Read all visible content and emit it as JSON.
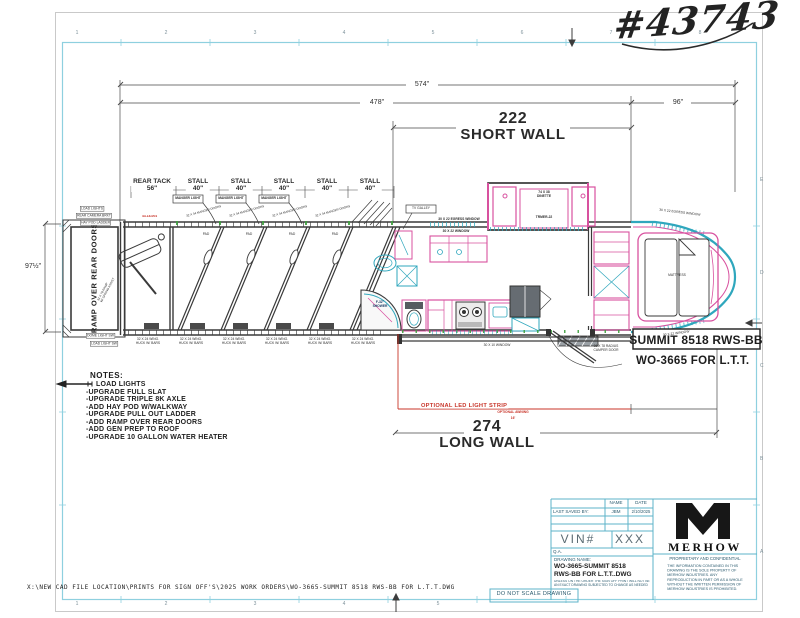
{
  "sheet": {
    "handwritten_number": "#43743",
    "footer_path": "X:\\NEW CAD FILE LOCATION\\PRINTS FOR SIGN OFF'S\\2025 WORK ORDERS\\WO-3665-SUMMIT 8518 RWS-BB FOR L.T.T.DWG",
    "do_not_scale": "DO NOT SCALE DRAWING",
    "ruler_cols": [
      "1",
      "2",
      "3",
      "4",
      "5",
      "6",
      "7",
      "8"
    ],
    "ruler_rows": [
      "E",
      "D",
      "C",
      "B",
      "A"
    ]
  },
  "dims": {
    "total": "574\"",
    "body": "478\"",
    "nose": "96\"",
    "height": "97½\"",
    "short_wall_value": "222",
    "short_wall_label": "SHORT WALL",
    "long_wall_value": "274",
    "long_wall_label": "LONG WALL"
  },
  "horse_area": {
    "rear_tack_label": "REAR TACK",
    "rear_tack_size": "56\"",
    "stall_label": "STALL",
    "stall_size": "40\"",
    "manger_light": "MANGER LIGHT",
    "manger_door": "32 X 34 MANGER DOORS",
    "pad": "PAD",
    "wing_line1": "32 X 24 WING.",
    "wing_line2": "HUCK W/ BARS",
    "ramp_label": "RAMP OVER REAR DOORS",
    "ramp_note_1": "32 X 78 RAMP",
    "ramp_note_2": "W/ SPRING ASSIST",
    "code_red": "43-18-004",
    "callouts": [
      "LOAD LIGHTS",
      "REAR CAMERA BRKT",
      "HAY POD LADDER",
      "DOME LIGHT SW",
      "LOAD LIGHT SW"
    ]
  },
  "lq": {
    "tv_galley": "TV GALLEY",
    "egress_window": "30 X 22 EGRESS WINDOW",
    "window": "30 X 22 WINDOW",
    "dinette_line1": "74 X 38",
    "dinette_line2": "DINETTE",
    "dinette_model": "TRMER-22",
    "shower_line1": "F-32\"",
    "shower_line2": "SHOWER",
    "kitchen_window": "30 X 10 WINDOW",
    "camper_door_line1": "36 X 78 RADIUS",
    "camper_door_line2": "CAMPER DOOR",
    "mattress": "MATTRESS",
    "nose_egress_window": "30 X 22 EGRESS WINDOW",
    "nose_window": "30 X 22 WINDOW"
  },
  "options": {
    "led_strip": "OPTIONAL LED LIGHT STRIP",
    "awning": "OPTIONAL AWNING",
    "awning_size": "16'"
  },
  "model": {
    "title": "SUMMIT 8518 RWS-BB",
    "work_order": "WO-3665 FOR L.T.T."
  },
  "notes": {
    "heading": "NOTES:",
    "items": [
      "LOAD LIGHTS",
      "-UPGRADE FULL SLAT",
      "-UPGRADE TRIPLE 8K AXLE",
      "-ADD HAY POD W/WALKWAY",
      "-UPGRADE PULL OUT LADDER",
      "-ADD RAMP OVER REAR DOORS",
      "-ADD GEN PREP TO ROOF",
      "-UPGRADE 10 GALLON WATER HEATER"
    ]
  },
  "title_block": {
    "name_header": "NAME",
    "date_header": "DATE",
    "last_saved": "LAST SAVED BY:",
    "saved_name": "JBM",
    "saved_date": "2/10/2025",
    "vin_label": "VIN#",
    "vin_value": "XXX",
    "qa": "Q.A.",
    "drawing_name_label": "DRAWING NAME:",
    "drawing_name_1": "WO-3665-SUMMIT 8518",
    "drawing_name_2": "RWS-BB FOR L.T.T..DWG",
    "disclaimer": "UNLESS ON THE ORDER THE SIGN OFF PRINT WILL NOT BE AN EXACT DRAWING SUBJECTED TO CHANGE AS NEEDED",
    "brand": "MERHOW",
    "confidential_title": "PROPRIETARY AND CONFIDENTIAL",
    "confidential_lines": [
      "THE INFORMATION CONTAINED IN THIS",
      "DRAWING IS THE SOLE PROPERTY OF",
      "MERHOW INDUSTRIES.  ANY",
      "REPRODUCTION IN PART OR AS A WHOLE",
      "WITHOUT THE WRITTEN PERMISSION OF",
      "MERHOW INDUSTRIES IS PROHIBITED."
    ]
  },
  "colors": {
    "border_cyan": "#8ed0df",
    "title_cyan": "#5db3c9",
    "pink": "#d8519f",
    "teal": "#2fa7bd",
    "red": "#c8352a",
    "green": "#3f9f3f",
    "ink": "#333333"
  }
}
